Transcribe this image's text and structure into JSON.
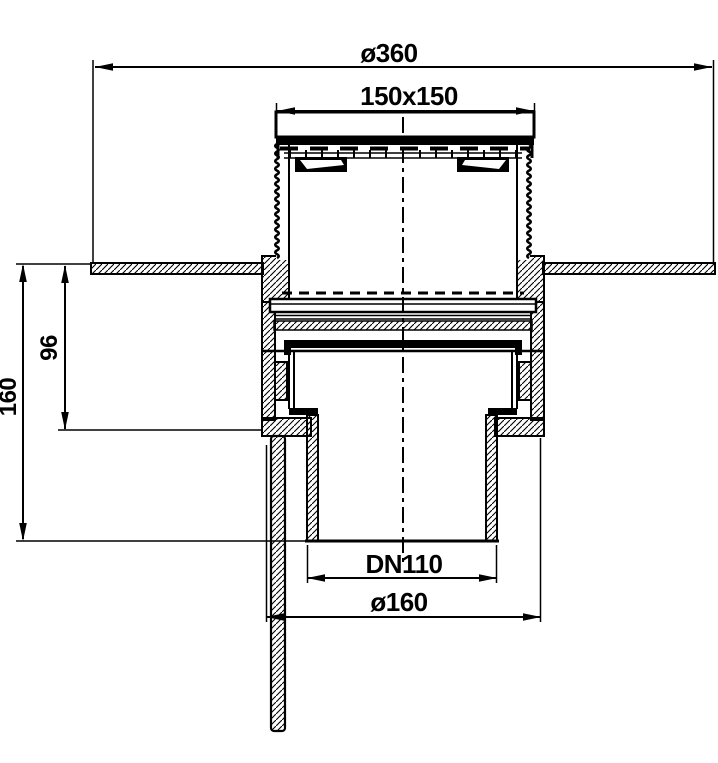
{
  "colors": {
    "ink": "#000000",
    "paper": "#ffffff"
  },
  "dimensions": {
    "flange_diameter": "ø360",
    "grate_size": "150x150",
    "trap_depth": "96",
    "total_depth": "160",
    "outlet": "DN110",
    "body_diameter": "ø160"
  }
}
